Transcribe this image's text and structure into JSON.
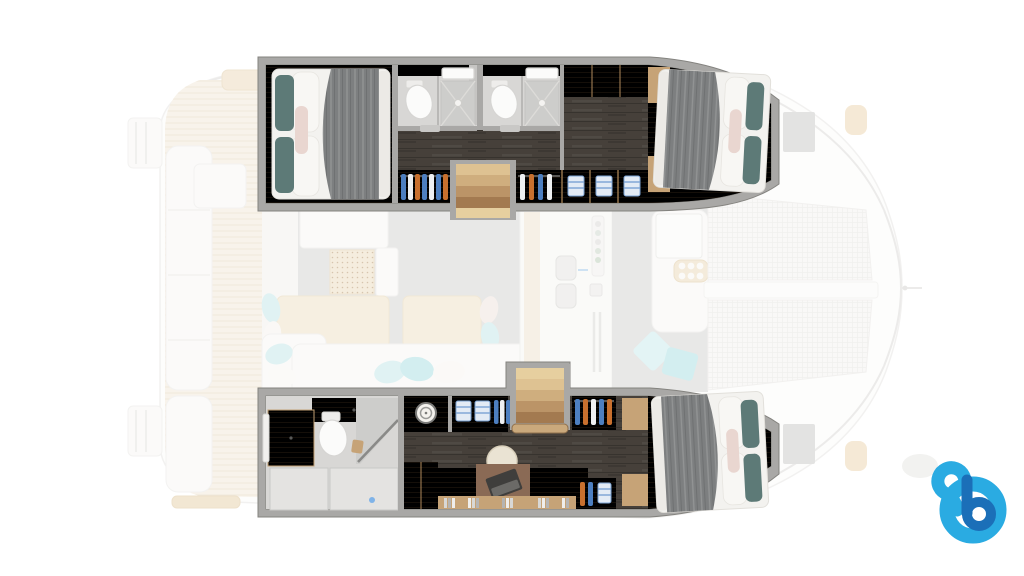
{
  "meta": {
    "title": "Catamaran yacht floor plan — lower deck cabins (main deck faded)",
    "view": "top-down",
    "orientation": "bow-right"
  },
  "colors": {
    "background": "#ffffff",
    "wall_gray": "#a9a8a6",
    "wall_edge": "#84837f",
    "oak_light": "#dcбf94",
    "oak_mid": "#c6a377",
    "floor_dark_wood": "#46403a",
    "bath_floor": "#d8d7d5",
    "shower_floor": "#cdcdcb",
    "white_fixture": "#fbfbfa",
    "mattress_white": "#f3f2ef",
    "duvet_gray": "#7d7f80",
    "pillow_teal": "#5d7a77",
    "pillow_pink": "#e9d6d0",
    "sofa_aqua": "#c2e7e8",
    "cushion_teal": "#a9dfe2",
    "deck_white": "#fcfcfb",
    "deck_edge": "#e6e5e3",
    "teak_faded": "#f3e9d8",
    "salon_floor": "#d3d2d0",
    "mesh": "#f4f3f1",
    "hanger_blue": "#4d7fc0",
    "hanger_orange": "#c8702e",
    "logo_light_blue": "#2aabe2",
    "logo_dark_blue": "#1b6fb8"
  },
  "floorplan": {
    "vessel": "catamaran",
    "highlighted_deck": "hull cabins (full color)",
    "faded_deck": "main deck salon, cockpits, trampolines",
    "starboard_hull_top": {
      "aft_cabin": [
        "double-bed",
        "gray-duvet",
        "teal-pillows",
        "pink-pillow",
        "oak-floor"
      ],
      "bathroom_1": [
        "toilet",
        "shower",
        "vanity"
      ],
      "bathroom_2": [
        "toilet",
        "shower",
        "vanity"
      ],
      "companionway": [
        "stairs",
        "hanging-wardrobe",
        "shelf-wardrobe",
        "dark-wood-floor"
      ],
      "forward_cabin": [
        "double-bed",
        "gray-duvet",
        "teal-pillows",
        "pink-pillow"
      ]
    },
    "port_hull_bottom": {
      "aft_bathroom": [
        "toilet",
        "vanity",
        "walk-in-shower",
        "glass-partition"
      ],
      "utility": [
        "washing-machine",
        "shelf-wardrobe",
        "hanging-wardrobe",
        "stairs"
      ],
      "office": [
        "desk",
        "laptop",
        "office-chair",
        "bookshelf",
        "hanging-lockers"
      ],
      "forward_cabin": [
        "double-bed",
        "gray-duvet",
        "teal-pillows",
        "pink-pillow"
      ]
    },
    "main_deck_faded": {
      "aft_cockpit": [
        "bench-seating",
        "table",
        "teak-deck",
        "swim-platforms"
      ],
      "salon": [
        "l-shaped-sofa",
        "scatter-cushions",
        "dining-tables",
        "nav-station",
        "speaker-panel"
      ],
      "galley": [
        "double-sink",
        "hob-knobs",
        "spice-rack",
        "grill"
      ],
      "forward_cockpit": [
        "bench",
        "table",
        "cup-holder-tray",
        "teal-cushions"
      ],
      "bow": [
        "trampoline-net-port",
        "trampoline-net-starboard",
        "center-walkway",
        "forestay"
      ]
    }
  },
  "logo": {
    "name": "b-logo",
    "glyph": "lowercase-b-swirl",
    "light_blue": "#2aabe2",
    "dark_blue": "#1b6fb8"
  }
}
